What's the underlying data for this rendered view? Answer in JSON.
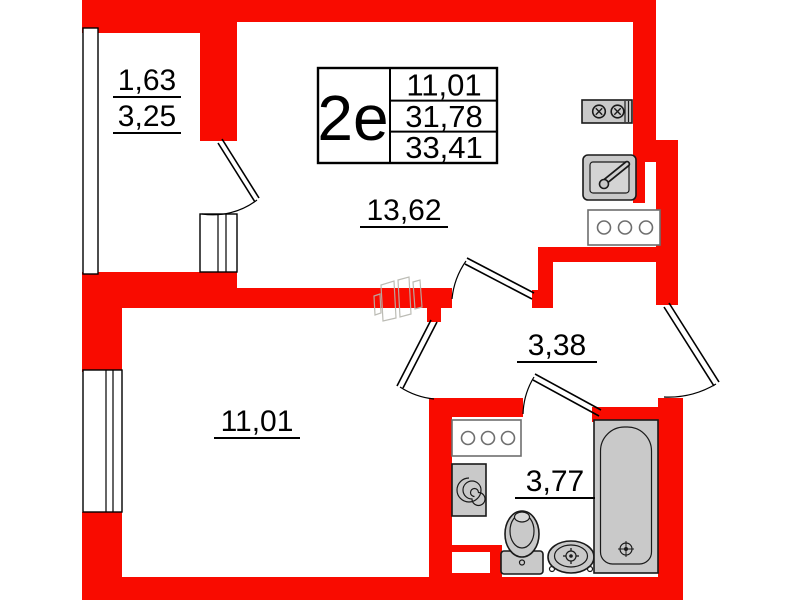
{
  "colors": {
    "wall": "#f90b00",
    "fixture_fill": "#c9c9c9",
    "fixture_stroke": "#1a1a1a",
    "counter_stroke": "#6e6e6e",
    "watermark": "#b5b5ad"
  },
  "info_box": {
    "type_label": "2e",
    "rows": [
      "11,01",
      "31,78",
      "33,41"
    ]
  },
  "rooms": {
    "balcony": {
      "labels": [
        "1,63",
        "3,25"
      ]
    },
    "kitchen": {
      "label": "13,62"
    },
    "bedroom": {
      "label": "11,01"
    },
    "hallway": {
      "label": "3,38"
    },
    "bathroom": {
      "label": "3,77"
    }
  },
  "icons": {
    "stove": "two-burner cooktop, top view",
    "kitchen-sink": "sink with faucet, top view",
    "kitchen-counter": "counter with three circles",
    "bathroom-counter": "counter with three circles",
    "washing-machine": "square with spiral drum",
    "toilet": "toilet with tank, top view",
    "wash-basin": "oval basin with tap cross",
    "bathtub": "bathtub with drain, top view"
  }
}
